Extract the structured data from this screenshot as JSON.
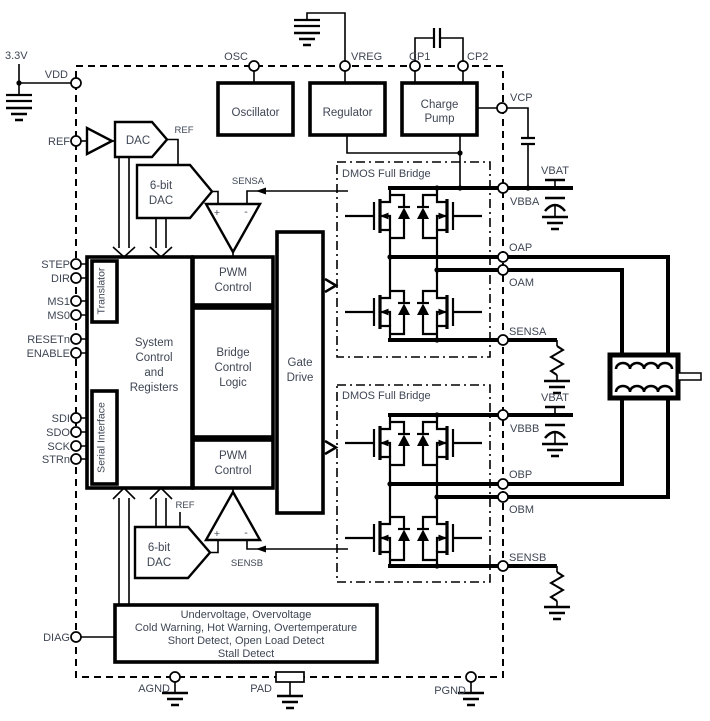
{
  "colors": {
    "line": "#000000",
    "text": "#3e4654",
    "background": "#ffffff"
  },
  "pins": {
    "supply_3v3": "3.3V",
    "vdd": "VDD",
    "ref": "REF",
    "step": "STEP",
    "dir": "DIR",
    "ms1": "MS1",
    "ms0": "MS0",
    "resetn": "RESETn",
    "enable": "ENABLE",
    "sdi": "SDI",
    "sdo": "SDO",
    "sck": "SCK",
    "strn": "STRn",
    "diag": "DIAG",
    "osc": "OSC",
    "vreg": "VREG",
    "cp1": "CP1",
    "cp2": "CP2",
    "vcp": "VCP",
    "vbba": "VBBA",
    "vbat_a": "VBAT",
    "oap": "OAP",
    "oam": "OAM",
    "sensa": "SENSA",
    "vbbb": "VBBB",
    "vbat_b": "VBAT",
    "obp": "OBP",
    "obm": "OBM",
    "sensb": "SENSB",
    "agnd": "AGND",
    "pad": "PAD",
    "pgnd": "PGND"
  },
  "signals": {
    "ref_dac_out": "REF",
    "ref_dacb_in": "REF",
    "sensa": "SENSA",
    "sensb": "SENSB",
    "comp_a_plus": "+",
    "comp_a_minus": "-",
    "comp_b_plus": "+",
    "comp_b_minus": "-"
  },
  "blocks": {
    "oscillator": "Oscillator",
    "regulator": "Regulator",
    "charge_pump": [
      "Charge",
      "Pump"
    ],
    "dac": "DAC",
    "dac6_top": [
      "6-bit",
      "DAC"
    ],
    "dac6_bottom": [
      "6-bit",
      "DAC"
    ],
    "translator": "Translator",
    "serial_interface": "Serial Interface",
    "system_control": [
      "System",
      "Control",
      "and",
      "Registers"
    ],
    "pwm_top": [
      "PWM",
      "Control"
    ],
    "bridge_logic": [
      "Bridge",
      "Control",
      "Logic"
    ],
    "pwm_bottom": [
      "PWM",
      "Control"
    ],
    "gate_drive": [
      "Gate",
      "Drive"
    ],
    "bridge_a": "DMOS Full Bridge",
    "bridge_b": "DMOS Full Bridge",
    "fault": [
      "Undervoltage, Overvoltage",
      "Cold Warning, Hot Warning, Overtemperature",
      "Short Detect, Open Load Detect",
      "Stall Detect"
    ]
  }
}
